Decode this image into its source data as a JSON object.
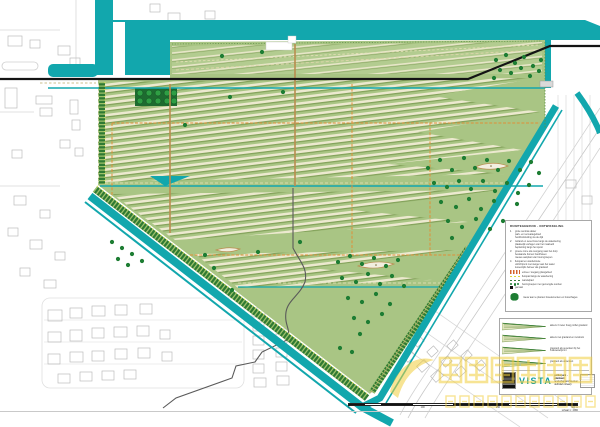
{
  "colors": {
    "water": "#12a7ad",
    "site_green": "#a9c584",
    "zone_green": "#b3cc90",
    "stripe_cream": "#ece9cf",
    "stripe_olive": "#7e9e55",
    "tree": "#1d7d33",
    "dike_dark": "#2f7a33",
    "dike_tick": "#9dc06b",
    "yellow_dots": "#eeec52",
    "orange_route": "#e09038",
    "tan_path": "#b98d4f",
    "rail_black": "#141414",
    "context_gray": "#bcbcbc",
    "watermark_yellow": "#f2cf3d"
  },
  "map": {
    "name": "polder site plan",
    "trees": [
      [
        496,
        60
      ],
      [
        506,
        55
      ],
      [
        515,
        63
      ],
      [
        524,
        57
      ],
      [
        533,
        66
      ],
      [
        541,
        60
      ],
      [
        500,
        70
      ],
      [
        511,
        73
      ],
      [
        521,
        68
      ],
      [
        530,
        76
      ],
      [
        539,
        71
      ],
      [
        494,
        78
      ],
      [
        222,
        56
      ],
      [
        262,
        52
      ],
      [
        283,
        92
      ],
      [
        185,
        125
      ],
      [
        230,
        97
      ],
      [
        428,
        168
      ],
      [
        440,
        160
      ],
      [
        452,
        170
      ],
      [
        464,
        158
      ],
      [
        475,
        168
      ],
      [
        487,
        160
      ],
      [
        498,
        170
      ],
      [
        509,
        161
      ],
      [
        520,
        170
      ],
      [
        531,
        162
      ],
      [
        539,
        173
      ],
      [
        434,
        183
      ],
      [
        447,
        187
      ],
      [
        459,
        181
      ],
      [
        471,
        189
      ],
      [
        483,
        181
      ],
      [
        495,
        191
      ],
      [
        507,
        183
      ],
      [
        518,
        193
      ],
      [
        529,
        185
      ],
      [
        441,
        202
      ],
      [
        456,
        207
      ],
      [
        469,
        199
      ],
      [
        481,
        209
      ],
      [
        494,
        201
      ],
      [
        517,
        204
      ],
      [
        448,
        221
      ],
      [
        462,
        227
      ],
      [
        476,
        219
      ],
      [
        490,
        229
      ],
      [
        503,
        221
      ],
      [
        452,
        238
      ],
      [
        112,
        242
      ],
      [
        122,
        248
      ],
      [
        132,
        254
      ],
      [
        118,
        259
      ],
      [
        128,
        265
      ],
      [
        142,
        261
      ],
      [
        338,
        262
      ],
      [
        350,
        256
      ],
      [
        362,
        264
      ],
      [
        374,
        258
      ],
      [
        386,
        266
      ],
      [
        398,
        260
      ],
      [
        342,
        278
      ],
      [
        356,
        282
      ],
      [
        368,
        274
      ],
      [
        380,
        284
      ],
      [
        392,
        276
      ],
      [
        404,
        286
      ],
      [
        348,
        298
      ],
      [
        362,
        302
      ],
      [
        376,
        294
      ],
      [
        390,
        304
      ],
      [
        354,
        318
      ],
      [
        368,
        322
      ],
      [
        382,
        314
      ],
      [
        360,
        334
      ],
      [
        340,
        348
      ],
      [
        352,
        352
      ],
      [
        205,
        255
      ],
      [
        232,
        290
      ],
      [
        258,
        252
      ],
      [
        300,
        242
      ],
      [
        214,
        268
      ]
    ],
    "context_buildings": [
      [
        8,
        36,
        14,
        10,
        0
      ],
      [
        30,
        40,
        10,
        8,
        0
      ],
      [
        58,
        46,
        12,
        9,
        0
      ],
      [
        70,
        58,
        10,
        7,
        0
      ],
      [
        150,
        4,
        10,
        8,
        0
      ],
      [
        168,
        13,
        12,
        9,
        0
      ],
      [
        205,
        11,
        10,
        8,
        0
      ],
      [
        5,
        88,
        12,
        20,
        0
      ],
      [
        36,
        96,
        16,
        8,
        0
      ],
      [
        40,
        108,
        12,
        8,
        0
      ],
      [
        70,
        100,
        8,
        14,
        0
      ],
      [
        72,
        120,
        8,
        10,
        0
      ],
      [
        12,
        150,
        10,
        8,
        0
      ],
      [
        60,
        140,
        10,
        8,
        0
      ],
      [
        75,
        148,
        8,
        8,
        0
      ],
      [
        14,
        196,
        12,
        9,
        0
      ],
      [
        40,
        210,
        10,
        8,
        0
      ],
      [
        8,
        228,
        10,
        8,
        0
      ],
      [
        30,
        240,
        12,
        9,
        0
      ],
      [
        55,
        252,
        10,
        8,
        0
      ],
      [
        20,
        268,
        10,
        8,
        0
      ],
      [
        44,
        280,
        12,
        8,
        0
      ],
      [
        48,
        310,
        14,
        11,
        0
      ],
      [
        70,
        308,
        12,
        10,
        0
      ],
      [
        92,
        306,
        13,
        10,
        0
      ],
      [
        115,
        305,
        12,
        10,
        0
      ],
      [
        140,
        304,
        12,
        10,
        0
      ],
      [
        48,
        332,
        13,
        10,
        0
      ],
      [
        70,
        330,
        12,
        11,
        0
      ],
      [
        92,
        328,
        12,
        10,
        0
      ],
      [
        114,
        327,
        13,
        10,
        0
      ],
      [
        137,
        326,
        12,
        10,
        0
      ],
      [
        48,
        354,
        12,
        10,
        0
      ],
      [
        70,
        352,
        13,
        10,
        0
      ],
      [
        92,
        351,
        12,
        10,
        0
      ],
      [
        115,
        349,
        12,
        10,
        0
      ],
      [
        138,
        348,
        12,
        10,
        0
      ],
      [
        58,
        374,
        12,
        9,
        0
      ],
      [
        80,
        372,
        12,
        9,
        0
      ],
      [
        102,
        371,
        12,
        9,
        0
      ],
      [
        124,
        370,
        12,
        9,
        0
      ],
      [
        160,
        330,
        10,
        9,
        0
      ],
      [
        162,
        352,
        10,
        9,
        0
      ],
      [
        252,
        308,
        13,
        9,
        0
      ],
      [
        275,
        306,
        13,
        9,
        0
      ],
      [
        253,
        322,
        11,
        9,
        0
      ],
      [
        276,
        320,
        11,
        9,
        0
      ],
      [
        253,
        336,
        11,
        9,
        0
      ],
      [
        276,
        334,
        11,
        9,
        0
      ],
      [
        253,
        350,
        11,
        9,
        0
      ],
      [
        276,
        348,
        11,
        9,
        0
      ],
      [
        253,
        364,
        11,
        9,
        0
      ],
      [
        276,
        362,
        11,
        9,
        0
      ],
      [
        254,
        378,
        12,
        9,
        0
      ],
      [
        277,
        376,
        12,
        9,
        0
      ],
      [
        390,
        342,
        10,
        8,
        -42
      ],
      [
        404,
        352,
        10,
        8,
        -42
      ],
      [
        418,
        362,
        10,
        8,
        -42
      ],
      [
        432,
        372,
        10,
        8,
        -42
      ],
      [
        414,
        338,
        9,
        7,
        -42
      ],
      [
        428,
        348,
        9,
        7,
        -42
      ],
      [
        442,
        358,
        9,
        7,
        -42
      ],
      [
        456,
        368,
        9,
        7,
        -42
      ],
      [
        448,
        342,
        9,
        7,
        -42
      ],
      [
        462,
        352,
        9,
        7,
        -42
      ],
      [
        476,
        362,
        9,
        7,
        -42
      ],
      [
        566,
        180,
        10,
        8,
        0
      ],
      [
        582,
        196,
        10,
        8,
        0
      ]
    ]
  },
  "legend": {
    "title": "RUIMTEGEBRUIK - ONTWIKKELING",
    "items": [
      {
        "num": "1",
        "lines": [
          "grote centrale akker",
          "park- en recreatiegebied",
          "hoofdontsluiting via de dijk"
        ]
      },
      {
        "num": "2",
        "lines": [
          "rietland en oeverzone langs de waterkering",
          "plaatselijk verlagen van het maaiveld",
          "beplanting langs het spoor"
        ]
      },
      {
        "num": "3",
        "lines": [
          "groene zone als overgang naar het dorp",
          "bestaande bomen handhaven",
          "nieuwe aanplant van boomgroepen"
        ]
      },
      {
        "num": "4",
        "lines": [
          "fietspad en wandelroute",
          "uitzichtpunt met steiger aan het water",
          "tussentijds beheer als grasland"
        ]
      }
    ],
    "symbols": [
      {
        "kind": "orange",
        "label": "entree / toegang plangebied"
      },
      {
        "kind": "yellow",
        "label": "fietspad langs de waterkering"
      },
      {
        "kind": "green",
        "label": "wandelpad"
      },
      {
        "kind": "trees",
        "label": "boomgroepen met gemengde soorten"
      },
      {
        "kind": "square",
        "label": "gemaal"
      }
    ],
    "note": "nieuw aan te planten boselementen en bosschages"
  },
  "sections": {
    "rows": [
      {
        "label": "akkers 3 meter hoog profiel grasland"
      },
      {
        "label": "akkers met grasland en rietstrook"
      },
      {
        "label": "grasrand als oeverkant bij het zuidwestelijk lint"
      },
      {
        "label": "grasrand als akkerkant"
      }
    ]
  },
  "titleblock": {
    "logo": "VISTA",
    "firm": "landschapsarchitectuur",
    "project": "polderpark - plankaart",
    "sheet": "definitief ontwerp"
  },
  "scalebar": {
    "segments": [
      [
        16,
        "#141414"
      ],
      [
        16,
        "#ffffff"
      ],
      [
        32,
        "#141414"
      ],
      [
        40,
        "#ffffff"
      ],
      [
        56,
        "#141414"
      ],
      [
        48,
        "#ffffff"
      ],
      [
        20,
        "#141414"
      ]
    ],
    "labels": [
      "0",
      "100",
      "250",
      "500 m"
    ],
    "caption": "schaal 1 : 2000"
  },
  "watermark": {
    "text": "中国风景园林网",
    "subtext": "www.chla.com.cn"
  }
}
